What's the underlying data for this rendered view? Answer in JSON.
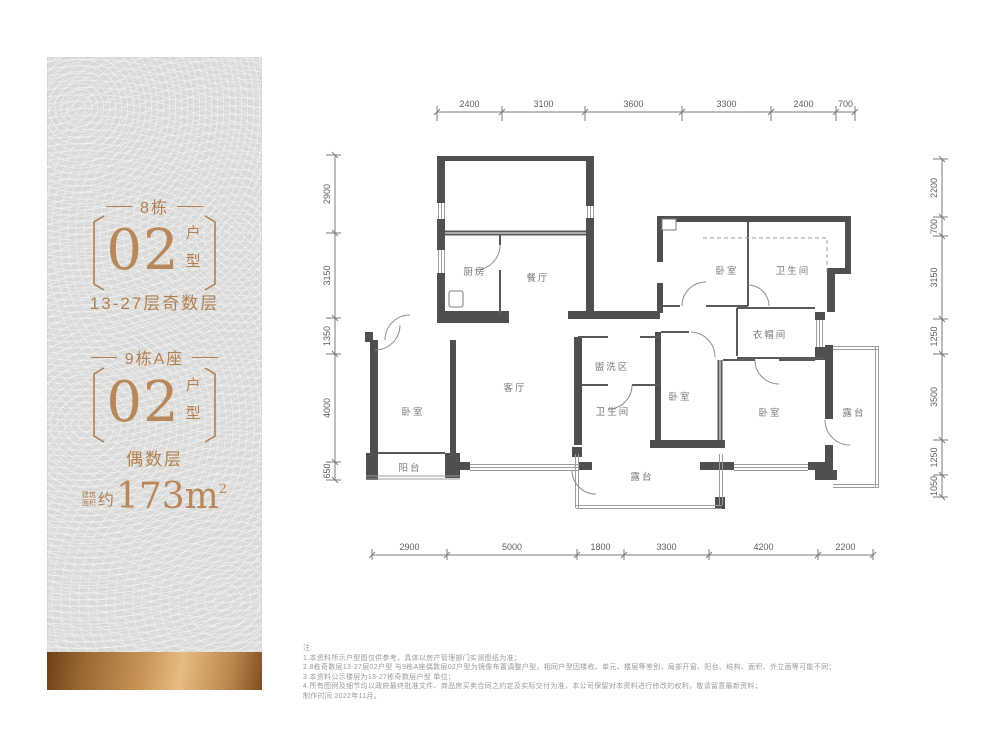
{
  "sidebar": {
    "block1": {
      "building": "8栋",
      "unit_number": "02",
      "unit_label": "户型",
      "floors": "13-27层奇数层"
    },
    "block2": {
      "building": "9栋A座",
      "unit_number": "02",
      "unit_label": "户型",
      "floors": "偶数层"
    },
    "area": {
      "pre_line1": "建筑",
      "pre_line2": "面积",
      "approx": "约",
      "value": "173m",
      "sup": "2"
    }
  },
  "plan": {
    "rooms": [
      {
        "label": "厨房"
      },
      {
        "label": "餐厅"
      },
      {
        "label": "卧室"
      },
      {
        "label": "卫生间"
      },
      {
        "label": "衣帽间"
      },
      {
        "label": "客厅"
      },
      {
        "label": "卧室"
      },
      {
        "label": "阳台"
      },
      {
        "label": "盥洗区"
      },
      {
        "label": "卫生间"
      },
      {
        "label": "卧室"
      },
      {
        "label": "卧室"
      },
      {
        "label": "露台"
      },
      {
        "label": "露台"
      }
    ],
    "dims": {
      "top": {
        "values": [
          "2400",
          "3100",
          "3600",
          "3300",
          "2400",
          "700"
        ]
      },
      "bottom": {
        "values": [
          "2900",
          "5000",
          "1800",
          "3300",
          "4200",
          "2200"
        ]
      },
      "left": {
        "values": [
          "2900",
          "3150",
          "1350",
          "4000",
          "650"
        ]
      },
      "right": {
        "values": [
          "2200",
          "700",
          "3150",
          "1250",
          "3500",
          "1250",
          "1050"
        ]
      }
    }
  },
  "notes": {
    "lines": [
      "注:",
      "1.本资料所示户型图仅供参考，具体以房产管理部门实测图纸为准；",
      "2.8栋奇数层13-27层02户型 与9栋A座偶数层02户型为镜像布置调整户型，相同户型因楼栋、单元、楼层等差别，局部开窗、阳台、结构、面积、外立面等可能不同；",
      "3.本资料公示楼层为13-27栋奇数层户型 单位；",
      "4.所有图例及细节均以政府最终批准文件、商品房买卖合同之约定及实际交付为准，本公司保留对本资料进行修改的权利，敬请留意最新资料；",
      "制作时间:2022年11月。"
    ]
  }
}
